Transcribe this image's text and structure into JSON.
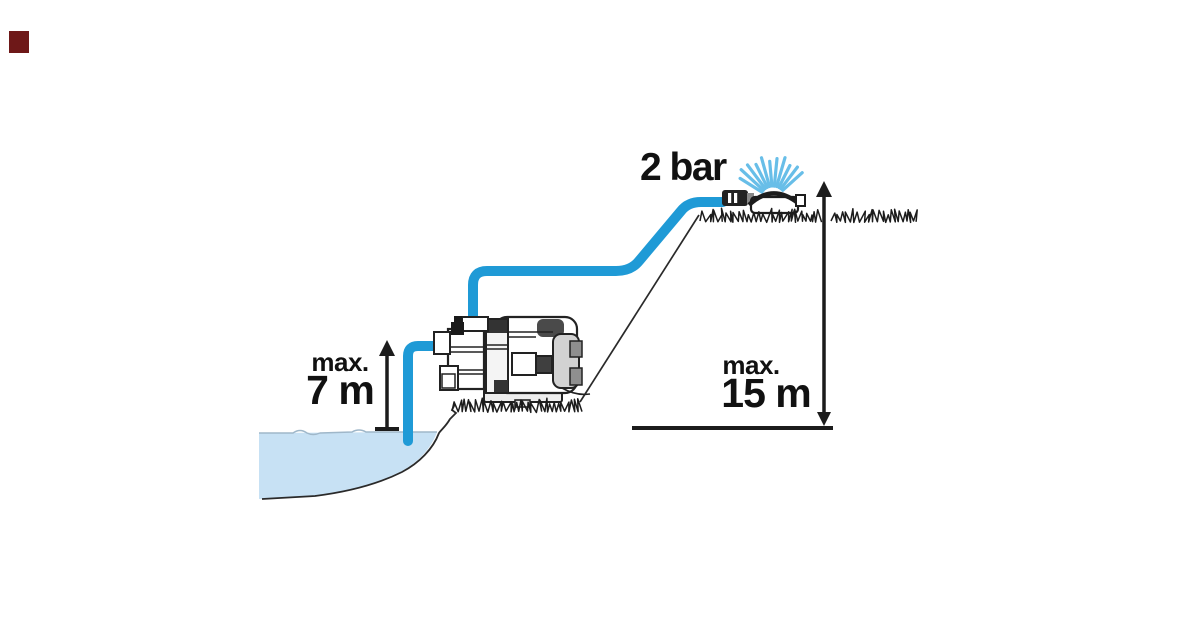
{
  "illustration": {
    "pressure_label": "2 bar",
    "suction_height": {
      "prefix": "max.",
      "value": "7 m"
    },
    "delivery_height": {
      "prefix": "max.",
      "value": "15 m"
    }
  },
  "colors": {
    "background": "#ffffff",
    "hose": "#1f9ad6",
    "spray": "#68bee8",
    "water_fill": "#c7e1f4",
    "water_edge": "#9fb7c9",
    "outline": "#1c1c1c",
    "text": "#111111",
    "corner_square": "#6e1818"
  }
}
